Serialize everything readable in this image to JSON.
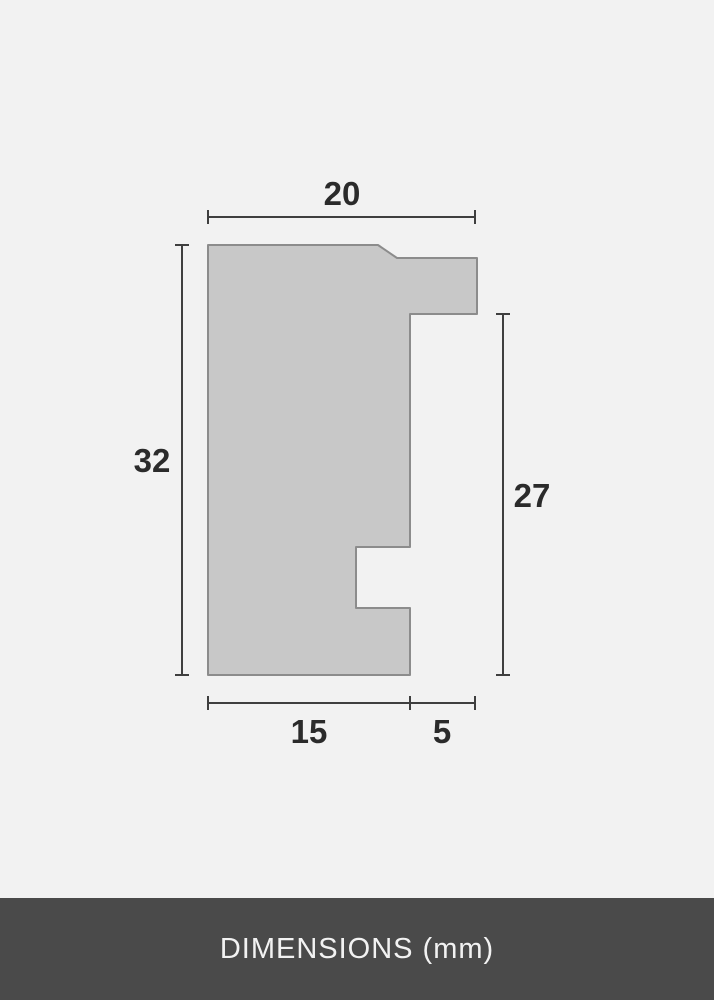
{
  "diagram": {
    "dimensions": {
      "top_width": "20",
      "left_height": "32",
      "right_height": "27",
      "bottom_inner_width": "15",
      "bottom_outer_width": "5"
    },
    "colors": {
      "background": "#f2f2f2",
      "profile_fill": "#c8c8c8",
      "profile_stroke": "#8c8c8c",
      "dimension_line": "#3f3f3f",
      "label_text": "#2b2b2b",
      "footer_background": "#4a4a4a",
      "footer_text": "#f2f2f2"
    }
  },
  "footer": {
    "label": "DIMENSIONS (mm)"
  }
}
